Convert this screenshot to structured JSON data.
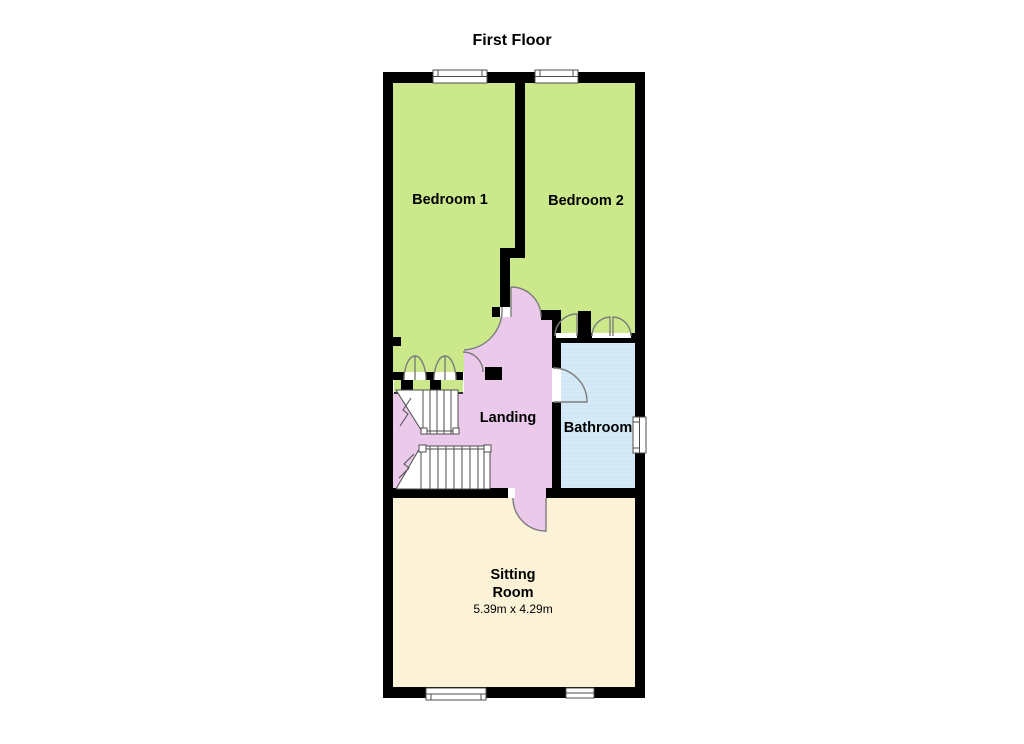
{
  "title": "First Floor",
  "rooms": {
    "bedroom1": {
      "label": "Bedroom 1"
    },
    "bedroom2": {
      "label": "Bedroom 2"
    },
    "landing": {
      "label": "Landing"
    },
    "bathroom": {
      "label": "Bathroom"
    },
    "sitting": {
      "label_line1": "Sitting",
      "label_line2": "Room",
      "dimensions": "5.39m x 4.29m"
    }
  },
  "colors": {
    "bedroom": "#cbe98a",
    "landing": "#eac9ea",
    "bathroom": "#d9edf8",
    "sitting": "#fdf4da",
    "wall": "#000000"
  }
}
